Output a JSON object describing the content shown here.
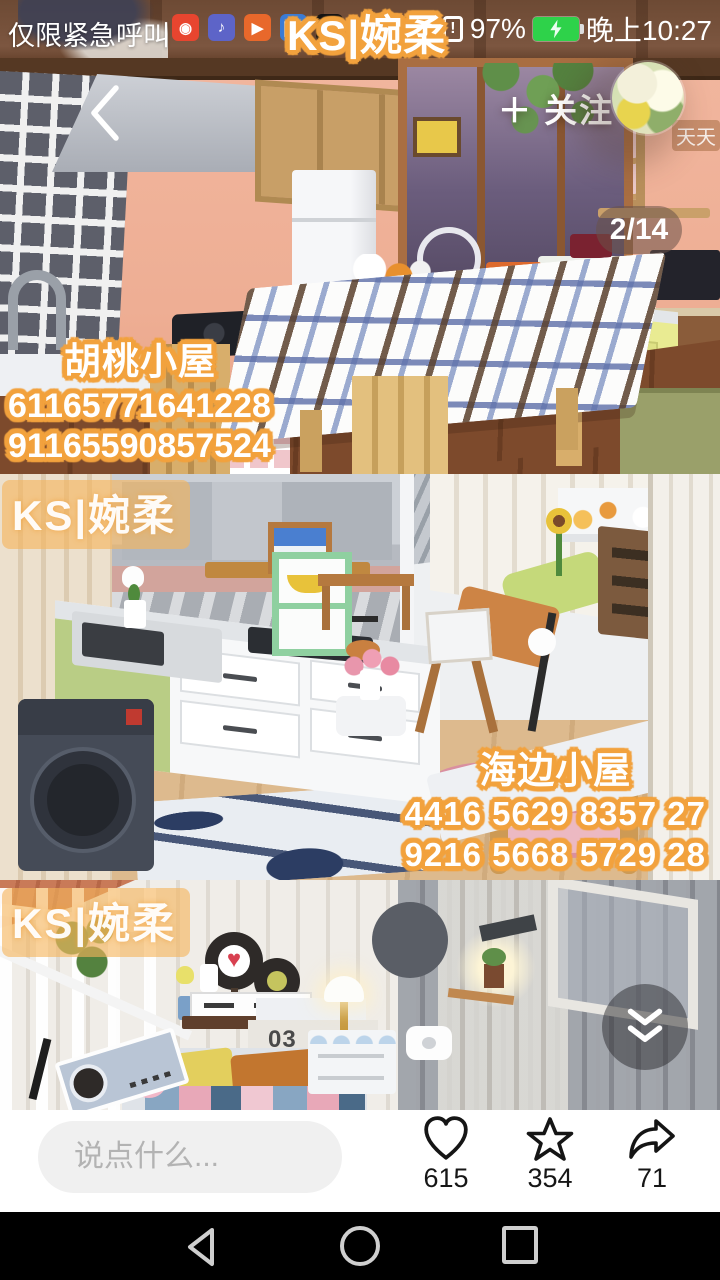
{
  "status_bar": {
    "carrier_text": "仅限紧急呼叫",
    "watermark": "KS|婉柔",
    "battery_percent": "97%",
    "time": "晚上10:27",
    "sim_alert": "!",
    "notification_icons": [
      {
        "name": "video-camera-app-icon",
        "glyph": "◉"
      },
      {
        "name": "music-note-app-icon",
        "glyph": "♪"
      },
      {
        "name": "play-app-icon",
        "glyph": "▶"
      },
      {
        "name": "book-app-icon",
        "glyph": "❚❚"
      },
      {
        "name": "tiktok-app-icon",
        "glyph": "♪"
      }
    ]
  },
  "header": {
    "back_icon": "chevron-left",
    "follow_label": "＋ 关注",
    "page_indicator": "2/14",
    "avatar_caption": "天天"
  },
  "photos": [
    {
      "title": "胡桃小屋",
      "codes": [
        "61165771641228",
        "91165590857524"
      ]
    },
    {
      "watermark": "KS|婉柔",
      "title": "海边小屋",
      "codes": [
        "4416 5629 8357 27",
        "9216 5668 5729 28"
      ]
    },
    {
      "watermark": "KS|婉柔",
      "shelf_label": "03"
    }
  ],
  "bottom_bar": {
    "comment_placeholder": "说点什么...",
    "actions": [
      {
        "name": "like",
        "icon": "heart-icon",
        "count": "615"
      },
      {
        "name": "favorite",
        "icon": "star-icon",
        "count": "354"
      },
      {
        "name": "share",
        "icon": "share-arrow-icon",
        "count": "71"
      }
    ]
  },
  "nav_bar": {
    "icons": [
      "back-triangle",
      "home-circle",
      "recents-square"
    ]
  },
  "colors": {
    "caption_outline": "#f2a23e",
    "watermark_bg": "#f6b45c",
    "battery_green": "#2ed24a",
    "bottom_bar_bg": "#ffffff",
    "nav_bar_bg": "#000000",
    "scene1_wall": "#f1b69e",
    "scene2_bg": "#eef0f2",
    "scene3_planks": "#f0ede8"
  }
}
